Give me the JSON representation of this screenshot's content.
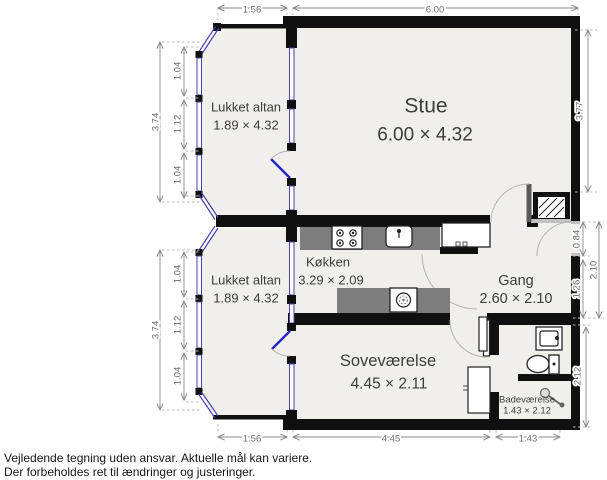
{
  "plan": {
    "rooms": {
      "lukket_altan_top": {
        "name": "Lukket altan",
        "size": "1.89 × 4.32"
      },
      "stue": {
        "name": "Stue",
        "size": "6.00 × 4.32"
      },
      "lukket_altan_bottom": {
        "name": "Lukket altan",
        "size": "1.89 × 4.32"
      },
      "koekken": {
        "name": "Køkken",
        "size": "3.29 × 2.09"
      },
      "gang": {
        "name": "Gang",
        "size": "2.60 × 2.10"
      },
      "sovevaerelse": {
        "name": "Soveværelse",
        "size": "4.45 × 2.11"
      },
      "badevaerelse": {
        "name": "Badeværelse",
        "size": "1.43 × 2.12"
      }
    },
    "dimensions": {
      "top": {
        "balcony_width": "1.56",
        "stue_width": "6.00"
      },
      "bottom": {
        "balcony_width": "1.56",
        "sovevaerelse_width": "4.45",
        "badevaerelse_width": "1.43"
      },
      "left_balcony_top": {
        "total": "3.74",
        "segments": [
          "1.04",
          "1.12",
          "1.04"
        ]
      },
      "left_balcony_bottom": {
        "total": "3.74",
        "segments": [
          "1.04",
          "1.12",
          "1.04"
        ]
      },
      "right": {
        "stue": "3.77",
        "entry": "0.84",
        "gang_lower": "1.26",
        "gang_total": "2.10",
        "badevaerelse": "2.12"
      }
    },
    "icons": [
      "stove-icon",
      "sink-icon",
      "washer-icon",
      "fridge-box",
      "toilet-icon",
      "bath-sink-icon",
      "shower-icon",
      "shaft-hatch"
    ]
  },
  "disclaimer": {
    "line1": "Vejledende tegning uden ansvar. Aktuelle mål kan variere.",
    "line2": "Der forbeholdes ret til ændringer og justeringer."
  },
  "colors": {
    "wall": "#101010",
    "floor": "#f0efec",
    "window_blue": "#4646ae",
    "door_blue": "#2525c8",
    "counter_gray": "#7d7d7d",
    "dimension_gray": "#8a8a8a",
    "label_gray": "#3d3d3d"
  }
}
